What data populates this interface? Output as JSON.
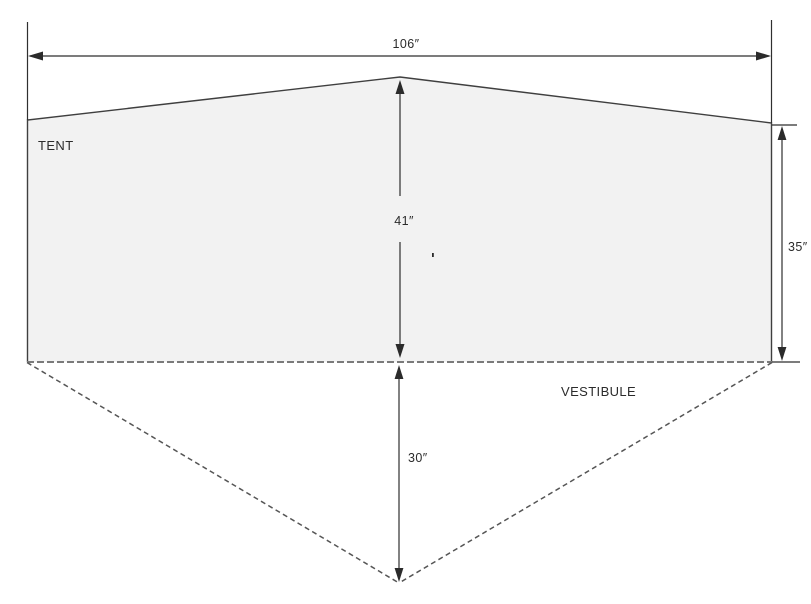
{
  "diagram": {
    "type": "tent-dimension-drawing",
    "tent_label": "TENT",
    "vestibule_label": "VESTIBULE",
    "dimensions": {
      "total_width": "106″",
      "peak_height": "41″",
      "side_height": "35″",
      "vestibule_depth": "30″"
    },
    "colors": {
      "background": "#ffffff",
      "tent_fill": "#f2f2f2",
      "outline": "#3f3f3f",
      "dimension_line": "#2f2f2f",
      "dashed_line": "#5f5f5f",
      "ground_dashed_line": "#7a7a7a"
    }
  }
}
